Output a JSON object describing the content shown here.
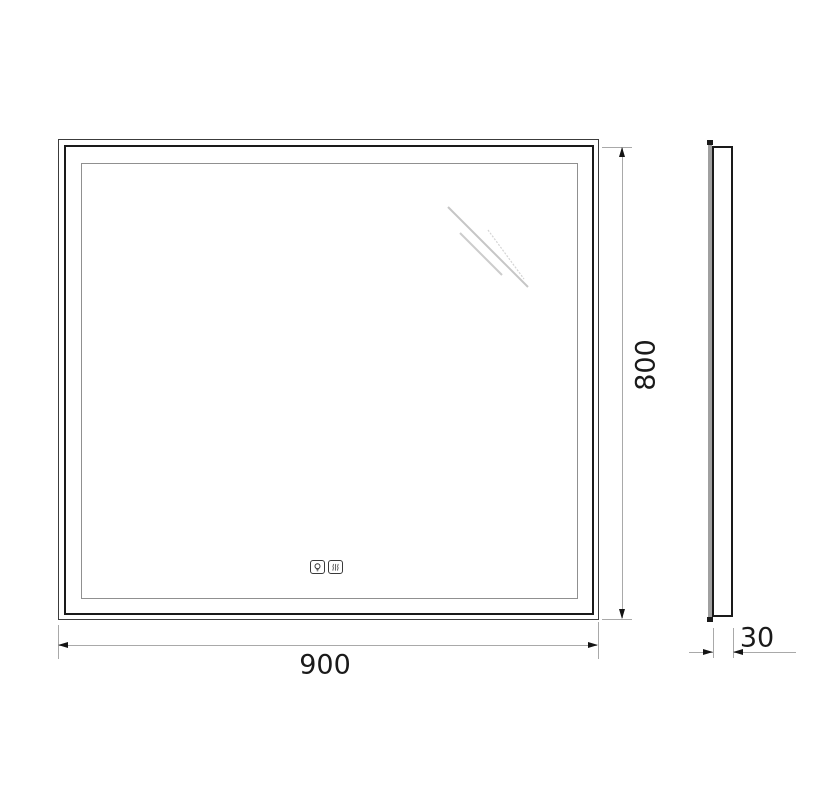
{
  "drawing": {
    "type": "technical-drawing",
    "subject": "led-mirror-front-and-side-view"
  },
  "dims": {
    "width": "900",
    "height": "800",
    "depth": "30"
  },
  "icons": [
    {
      "name": "light-bulb-icon",
      "glyph": "bulb"
    },
    {
      "name": "heater-waves-icon",
      "glyph": "waves"
    }
  ],
  "colors": {
    "line": "#1a1a1a",
    "edge": "#3c3c3c",
    "inner_border": "#909090",
    "dimension": "#a9a9a9",
    "reflection": "#c9c9c9",
    "background": "#ffffff"
  }
}
